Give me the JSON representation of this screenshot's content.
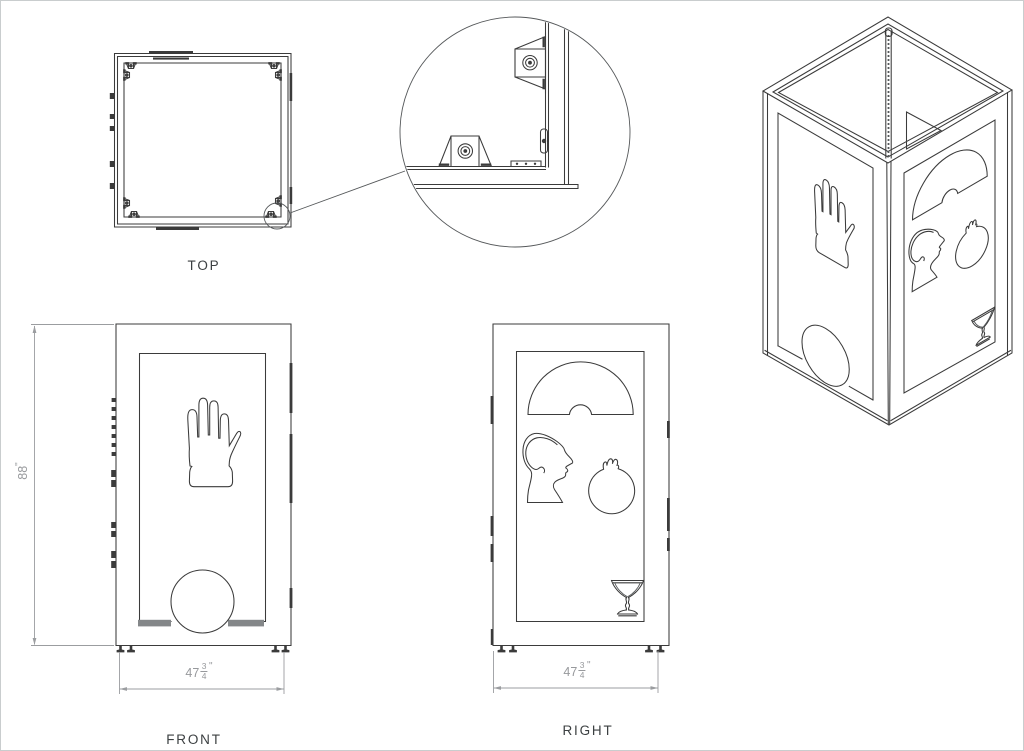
{
  "colors": {
    "line": "#3b3b3b",
    "dimension": "#9b9da0",
    "background": "#ffffff",
    "slot_fill": "#848789"
  },
  "views": {
    "top": {
      "label": "TOP"
    },
    "front": {
      "label": "FRONT",
      "height_dim": {
        "value": "88",
        "unit": "\""
      },
      "width_dim": {
        "whole": "47",
        "numerator": "3",
        "denominator": "4",
        "unit": "\""
      },
      "cutouts": [
        "hand",
        "dome-arch"
      ]
    },
    "right": {
      "label": "RIGHT",
      "width_dim": {
        "whole": "47",
        "numerator": "3",
        "denominator": "4",
        "unit": "\""
      },
      "cutouts": [
        "fan-arch",
        "head-profile",
        "pomegranate",
        "martini-glass"
      ]
    },
    "isometric": {
      "cutouts": [
        "hand",
        "dome-arch",
        "fan-arch",
        "head-profile",
        "pomegranate",
        "martini-glass"
      ]
    },
    "detail": {
      "feature": "corner-mounting-clips"
    }
  }
}
